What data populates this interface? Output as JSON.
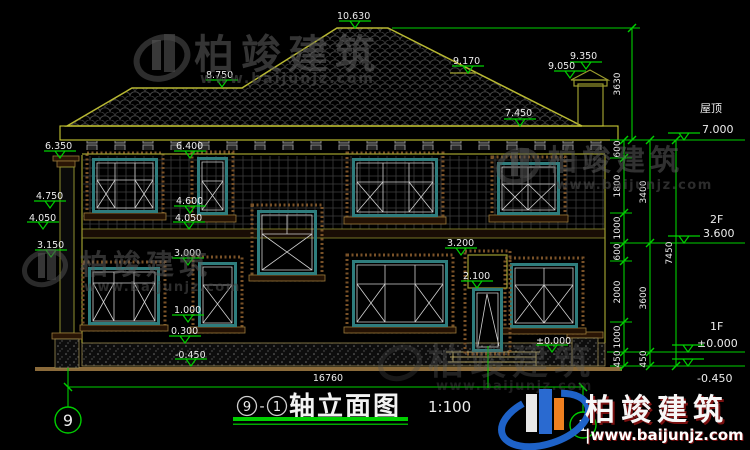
{
  "brand": {
    "name": "柏竣建筑",
    "url": "www.baijunjz.com",
    "url_piped": "|www.baijunjz.com"
  },
  "title_block": {
    "axis_from": "9",
    "dash": "-",
    "axis_to": "1",
    "name": "轴立面图",
    "scale": "1:100"
  },
  "grid": {
    "left_axis": "9",
    "right_axis": "1"
  },
  "floors": {
    "roof_label": "屋顶",
    "roof_level": "7.000",
    "f2_label": "2F",
    "f2_level": "3.600",
    "f1_label": "1F",
    "f1_level": "±0.000",
    "ground_level": "-0.450"
  },
  "levels": {
    "ridge": "10.630",
    "left_roof": "8.750",
    "rear_ridge": "9.170",
    "chimney_top": "9.350",
    "chimney_cap": "9.050",
    "eave": "7.450",
    "col_capital": "6.350",
    "win2_top": "6.400",
    "left_475": "4.750",
    "left_405": "4.050",
    "left_315": "3.150",
    "sill2": "4.600",
    "band_405": "4.050",
    "win1_top": "3.000",
    "sill1": "1.000",
    "plinth": "0.300",
    "ground": "-0.450",
    "door_trim": "3.200",
    "door_top": "2.100",
    "floor_zero": "±0.000"
  },
  "dims": {
    "total_width": "16760",
    "roof_height": "3630",
    "overall_right": "7450",
    "chain_a": [
      "600",
      "1800",
      "1000",
      "600",
      "2000",
      "1000",
      "450"
    ],
    "chain_b": [
      "3400",
      "3600",
      "450"
    ]
  }
}
